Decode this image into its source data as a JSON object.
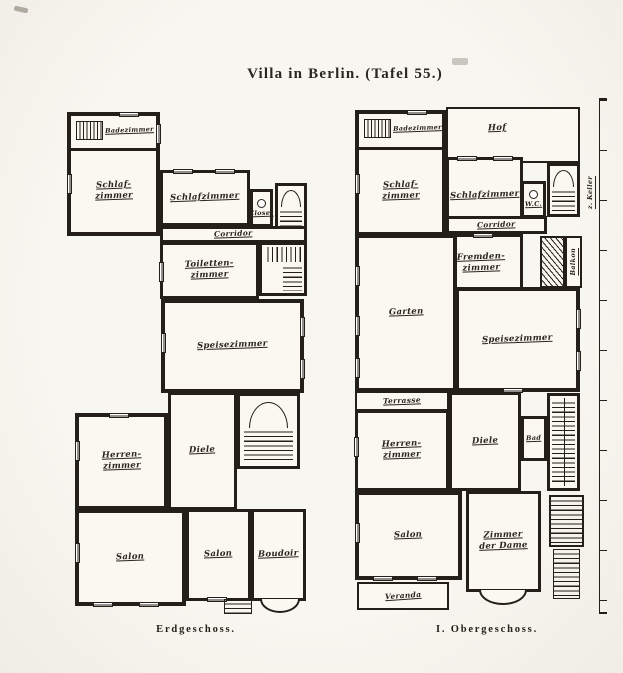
{
  "page": {
    "title": "Villa in Berlin. (Tafel 55.)",
    "ink_color": "#241f18",
    "paper_color": "#f5f3ec"
  },
  "erdgeschoss": {
    "caption": "Erdgeschoss.",
    "rooms": {
      "badezimmer": "Badezimmer",
      "schlafzimmer_links": {
        "l1": "Schlaf-",
        "l2": "zimmer"
      },
      "schlafzimmer_mitte": "Schlafzimmer",
      "closet": "Closet",
      "corridor": "Corridor",
      "toilettenzimmer": {
        "l1": "Toiletten-",
        "l2": "zimmer"
      },
      "speisezimmer": "Speisezimmer",
      "herrenzimmer": {
        "l1": "Herren-",
        "l2": "zimmer"
      },
      "diele": "Diele",
      "salon_gross": "Salon",
      "salon_klein": "Salon",
      "boudoir": "Boudoir"
    }
  },
  "obergeschoss": {
    "caption": "I. Obergeschoss.",
    "rooms": {
      "hof": "Hof",
      "badezimmer": "Badezimmer",
      "schlafzimmer_links": {
        "l1": "Schlaf-",
        "l2": "zimmer"
      },
      "schlafzimmer_mitte": "Schlafzimmer",
      "wc": "W.C.",
      "corridor": "Corridor",
      "fremdenzimmer": {
        "l1": "Fremden-",
        "l2": "zimmer"
      },
      "balkon": "Balkon",
      "garten": "Garten",
      "speisezimmer": "Speisezimmer",
      "terrasse": "Terrasse",
      "herrenzimmer": {
        "l1": "Herren-",
        "l2": "zimmer"
      },
      "diele": "Diele",
      "bad": "Bad",
      "salon": "Salon",
      "zimmer_der_dame": {
        "l1": "Zimmer",
        "l2": "der Dame"
      },
      "veranda": "Veranda"
    },
    "annotations": {
      "keller": "z. Keller"
    }
  }
}
